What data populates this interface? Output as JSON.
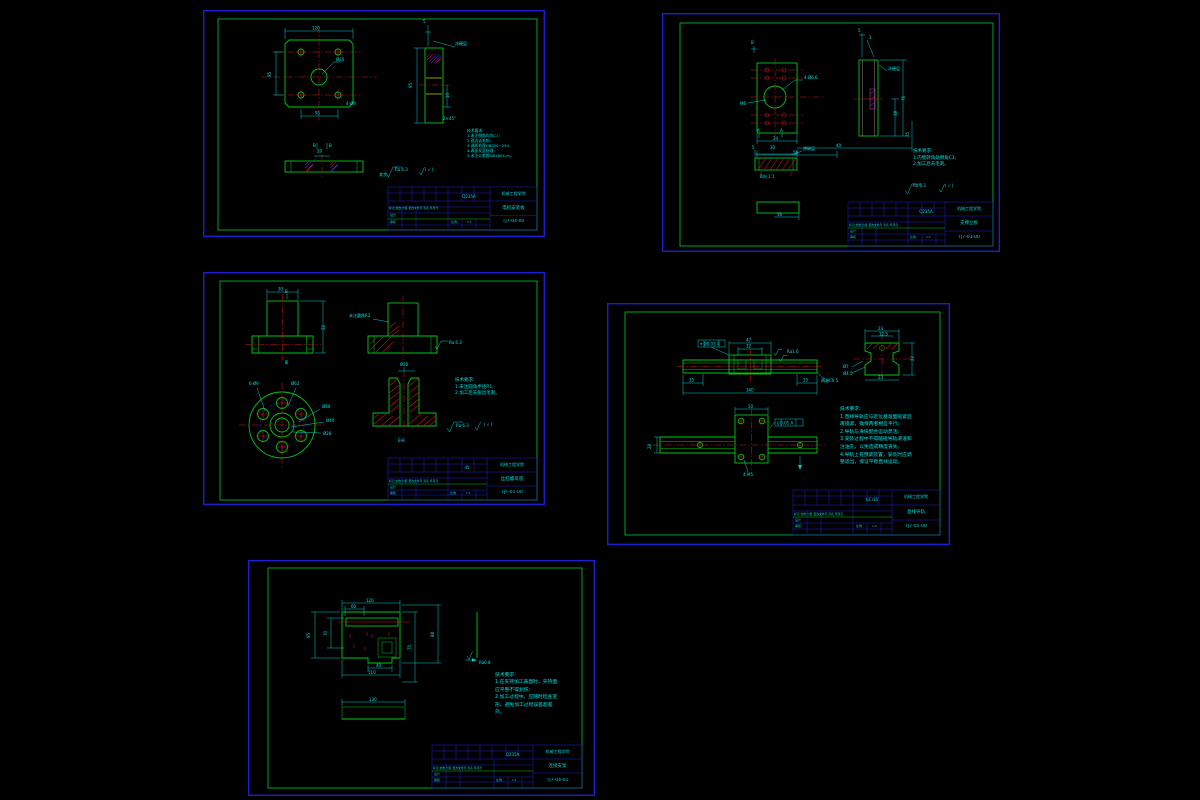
{
  "app": {
    "background": "#000000"
  },
  "colors": {
    "frame_blue": "#1d1dd2",
    "border_green": "#00a528",
    "part_green": "#00c814",
    "dimension_cyan": "#00cdcd",
    "text_cyan": "#00e0e0",
    "centerline_red": "#cd1616",
    "hatch_blue": "#2a2ad2",
    "hatch_yellow": "#c8c800",
    "hatch_magenta": "#c83cc8"
  },
  "sheets": [
    {
      "school": "机械工程学院",
      "part_name": "电机安装板",
      "drawing_no": "TJ7-04-00",
      "material": "Q235A",
      "scale_label": "比例",
      "scale": "1:1",
      "header_row": "标记 处数 分区 更改文件号 签名 年月日",
      "design_label": "设计",
      "check_label": "审核",
      "notes_title": "技术要求:",
      "notes": [
        "1.未注倒角均为C1;",
        "2.锐边去毛刺;",
        "3.调质处理HB220~250;",
        "4.表面发蓝处理;",
        "5.未注公差按GB1804-m。"
      ],
      "surface_finish": "Ra 6.3",
      "dims": [
        {
          "x": 109,
          "y": 19.5,
          "t": "120"
        },
        {
          "x": 68,
          "y": 67,
          "t": "95",
          "rot": 1
        },
        {
          "x": 112,
          "y": 104.5,
          "t": "95"
        },
        {
          "x": 133,
          "y": 51,
          "t": "Ø35"
        },
        {
          "x": 143,
          "y": 95,
          "t": "4-Ø9"
        },
        {
          "x": 220,
          "y": 13,
          "t": "5"
        },
        {
          "x": 252,
          "y": 35,
          "t": "淬硬层",
          "s": 3.5
        },
        {
          "x": 209,
          "y": 78,
          "t": "95",
          "rot": 1
        },
        {
          "x": 246,
          "y": 88,
          "t": "10",
          "rot": 1
        },
        {
          "x": 240,
          "y": 110,
          "t": "2×45°",
          "s": 3.5
        },
        {
          "x": 114,
          "y": 142.5,
          "t": "20"
        },
        {
          "x": 110,
          "y": 137,
          "t": "B",
          "s": 3.5
        },
        {
          "x": 126,
          "y": 137,
          "t": "B",
          "s": 3.5
        },
        {
          "x": 176,
          "y": 166,
          "t": "其余",
          "s": 3.2
        },
        {
          "x": 192,
          "y": 161,
          "t": "Ra 6.3"
        },
        {
          "x": 222,
          "y": 161,
          "t": "( √ )"
        }
      ]
    },
    {
      "school": "机械工程学院",
      "part_name": "支撑立板",
      "drawing_no": "TJ7-03-00",
      "material": "Q235A",
      "scale_label": "比例",
      "scale": "1:1",
      "header_row": "标记 处数 分区 更改文件号 签名 年月日",
      "design_label": "设计",
      "check_label": "审核",
      "notes_title": "技术要求:",
      "notes": [
        "1.内壁转角处倒角C1;",
        "2.加工后去毛刺。"
      ],
      "surface_finish": "Ra 6.3",
      "dims": [
        {
          "x": 89,
          "y": 31,
          "t": "B",
          "s": 3.5
        },
        {
          "x": 142,
          "y": 66,
          "t": "4-Ø6.6",
          "s": 3.5
        },
        {
          "x": 78,
          "y": 92,
          "t": "M6",
          "s": 3.5
        },
        {
          "x": 111,
          "y": 127,
          "t": "24"
        },
        {
          "x": 174,
          "y": 134,
          "t": "40"
        },
        {
          "x": 247,
          "y": 124,
          "t": "25",
          "rot": 1
        },
        {
          "x": 131,
          "y": 141,
          "t": "56"
        },
        {
          "x": 95,
          "y": 119,
          "t": "A",
          "s": 3.5
        },
        {
          "x": 118,
          "y": 119,
          "t": "A",
          "s": 3.5
        },
        {
          "x": 196,
          "y": 19,
          "t": "5"
        },
        {
          "x": 207,
          "y": 26,
          "t": "3"
        },
        {
          "x": 226,
          "y": 57,
          "t": "淬硬层",
          "s": 3.5
        },
        {
          "x": 235,
          "y": 103,
          "t": "38",
          "rot": 1
        },
        {
          "x": 243,
          "y": 88,
          "t": "76",
          "rot": 1
        },
        {
          "x": 90,
          "y": 136,
          "t": "5"
        },
        {
          "x": 108,
          "y": 136,
          "t": "30"
        },
        {
          "x": 141,
          "y": 137,
          "t": "渗碳层",
          "s": 3.5
        },
        {
          "x": 98,
          "y": 165,
          "t": "B向 1:1",
          "s": 4
        },
        {
          "x": 115,
          "y": 203,
          "t": "56"
        },
        {
          "x": 251,
          "y": 174,
          "t": "Ra 6.3"
        },
        {
          "x": 283,
          "y": 174,
          "t": "( √ )"
        }
      ]
    },
    {
      "school": "机械工程学院",
      "part_name": "丝杠螺母座",
      "drawing_no": "TJF-01-00",
      "material": "45",
      "scale_label": "比例",
      "scale": "1:1",
      "header_row": "标记 处数 分区 更改文件号 签名 年月日",
      "design_label": "设计",
      "check_label": "审核",
      "notes_title": "技术要求:",
      "notes": [
        "1.未注圆角半径R1;",
        "2.加工后去锐边毛刺。"
      ],
      "surface_finish": "Ra 6.3",
      "dims": [
        {
          "x": 75,
          "y": 18.5,
          "t": "30"
        },
        {
          "x": 82,
          "y": 21,
          "t": "B",
          "s": 3.5
        },
        {
          "x": 82,
          "y": 92,
          "t": "B",
          "s": 3.5
        },
        {
          "x": 122,
          "y": 58,
          "t": "52",
          "rot": 1
        },
        {
          "x": 146,
          "y": 45,
          "t": "未注圆角R2",
          "s": 3.2
        },
        {
          "x": 246,
          "y": 72,
          "t": "Ra 6.3",
          "s": 3.5
        },
        {
          "x": 46,
          "y": 113,
          "t": "6-Ø9",
          "s": 3.5
        },
        {
          "x": 88,
          "y": 113,
          "t": "Ø62",
          "s": 3.5
        },
        {
          "x": 119,
          "y": 136,
          "t": "Ø80",
          "s": 3.5
        },
        {
          "x": 123,
          "y": 150,
          "t": "Ø40",
          "s": 3.5
        },
        {
          "x": 120,
          "y": 163,
          "t": "Ø28",
          "s": 3.5
        },
        {
          "x": 197,
          "y": 94,
          "t": "Ø20",
          "s": 3.5
        },
        {
          "x": 195,
          "y": 170,
          "t": "B-B",
          "s": 5
        },
        {
          "x": 253,
          "y": 155,
          "t": "Ra 6.3"
        },
        {
          "x": 281,
          "y": 154,
          "t": "( √ )"
        }
      ]
    },
    {
      "school": "机械工程学院",
      "part_name": "直线导轨",
      "drawing_no": "TJ7-05-00",
      "material": "GCr15",
      "scale_label": "比例",
      "scale": "1:2",
      "header_row": "标记 处数 分区 更改文件号 签名 年月日",
      "design_label": "设计",
      "check_label": "审核",
      "notes_title": "技术要求:",
      "notes": [
        "1.直线导轨应与定位基准面贴紧后",
        "再锁紧，确保两者相互平行;",
        "2.导轨与滑块配合运动灵活;",
        "3.安装过程中不得磕碰导轨滚道和",
        "注油孔，以免造成精度丧失;",
        "4.导轨上有预紧装置，安装时应调",
        "整适当，保证平稳直线运动。"
      ],
      "surface_finish": "Ra 1.6",
      "dims": [
        {
          "x": 139,
          "y": 38.5,
          "t": "47"
        },
        {
          "x": 139,
          "y": 44.5,
          "t": "32"
        },
        {
          "x": 93,
          "y": 42.5,
          "t": "⌖ Ø0.01 A",
          "s": 3
        },
        {
          "x": 180,
          "y": 50,
          "t": "Ra1.6",
          "s": 3
        },
        {
          "x": 214,
          "y": 79,
          "t": "两端C0.5",
          "s": 3.2
        },
        {
          "x": 82,
          "y": 78.5,
          "t": "15"
        },
        {
          "x": 196,
          "y": 78.5,
          "t": "15"
        },
        {
          "x": 139,
          "y": 88.5,
          "t": "340"
        },
        {
          "x": 271,
          "y": 27,
          "t": "23"
        },
        {
          "x": 272,
          "y": 32.5,
          "t": "12.5",
          "s": 3
        },
        {
          "x": 236,
          "y": 65,
          "t": "Ø7",
          "s": 3.5
        },
        {
          "x": 236,
          "y": 72,
          "t": "Ø4.5",
          "s": 3.5
        },
        {
          "x": 307,
          "y": 58,
          "t": "22",
          "rot": 1
        },
        {
          "x": 271,
          "y": 76,
          "t": "23"
        },
        {
          "x": 141,
          "y": 105,
          "t": "50"
        },
        {
          "x": 170,
          "y": 121.5,
          "t": "∥ 0.01 A",
          "s": 3
        },
        {
          "x": 136,
          "y": 173,
          "t": "4-M5",
          "s": 3.5
        },
        {
          "x": 44,
          "y": 146,
          "t": "28",
          "rot": 1
        }
      ]
    },
    {
      "school": "机械工程学院",
      "part_name": "连接支架",
      "drawing_no": "TJ7-04-01",
      "material": "Q235A",
      "scale_label": "比例",
      "scale": "1:1",
      "header_row": "标记 处数 分区 更改文件号 签名 年月日",
      "design_label": "设计",
      "check_label": "审核",
      "notes_title": "技术要求:",
      "notes": [
        "1.在夹持加工表面时，夹持面",
        "应平整不得划伤;",
        "2.加工过程中，应随时检查变",
        "形，避免加工过程误差超差",
        "外。"
      ],
      "surface_finish": "Ra 0.8",
      "dims": [
        {
          "x": 118,
          "y": 42,
          "t": "120"
        },
        {
          "x": 103,
          "y": 48,
          "t": "60"
        },
        {
          "x": 62,
          "y": 78,
          "t": "95",
          "rot": 1
        },
        {
          "x": 79,
          "y": 76,
          "t": "70",
          "rot": 1
        },
        {
          "x": 163,
          "y": 90,
          "t": "75",
          "rot": 1
        },
        {
          "x": 186,
          "y": 77,
          "t": "88",
          "rot": 1
        },
        {
          "x": 128,
          "y": 107,
          "t": "40"
        },
        {
          "x": 120,
          "y": 114,
          "t": "110"
        },
        {
          "x": 231,
          "y": 104,
          "t": "Ra0.8",
          "s": 3.5
        },
        {
          "x": 121,
          "y": 141,
          "t": "130"
        }
      ]
    }
  ]
}
